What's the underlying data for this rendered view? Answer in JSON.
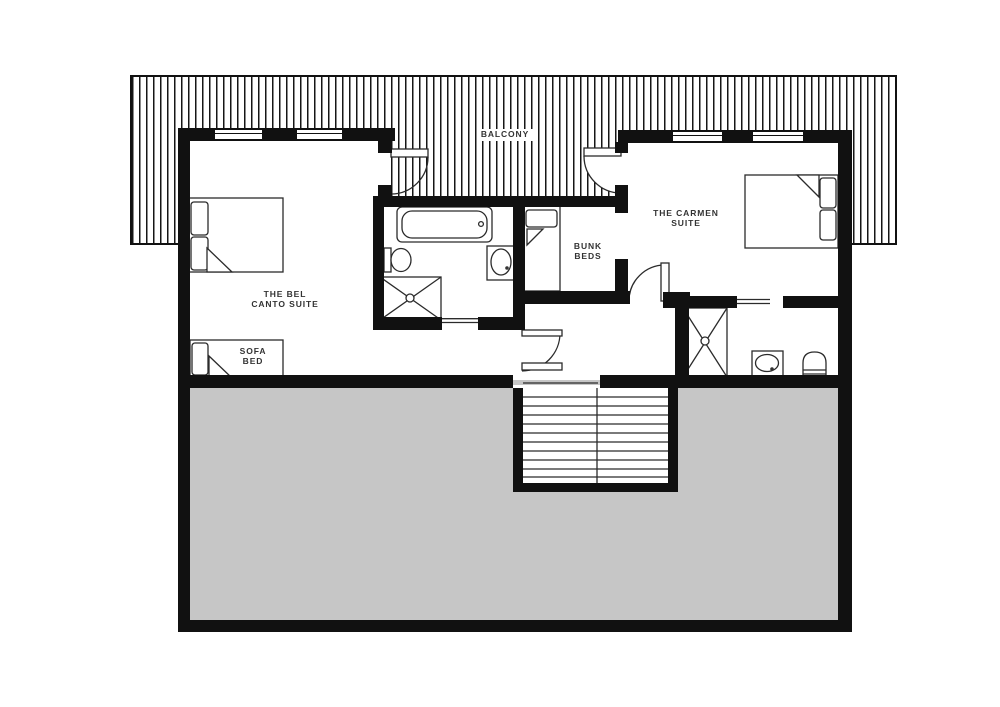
{
  "floorplan": {
    "balcony": {
      "label": "BALCONY"
    },
    "rooms": {
      "bel_canto_suite": {
        "line1": "THE BEL",
        "line2": "CANTO SUITE"
      },
      "sofa_bed": {
        "line1": "SOFA",
        "line2": "BED"
      },
      "bunk_beds": {
        "line1": "BUNK",
        "line2": "BEDS"
      },
      "carmen_suite": {
        "line1": "THE CARMEN",
        "line2": "SUITE"
      }
    },
    "fixtures": [
      "double-bed",
      "sofa-bed",
      "bunk-bed",
      "double-bed",
      "bathtub",
      "toilet",
      "shower",
      "sink",
      "shower",
      "sink",
      "toilet",
      "staircase",
      "balcony-door",
      "balcony-door",
      "room-door",
      "stair-door"
    ],
    "colors": {
      "wall": "#111111",
      "void_fill": "#c6c6c6",
      "outline": "#2b2b2b"
    }
  }
}
